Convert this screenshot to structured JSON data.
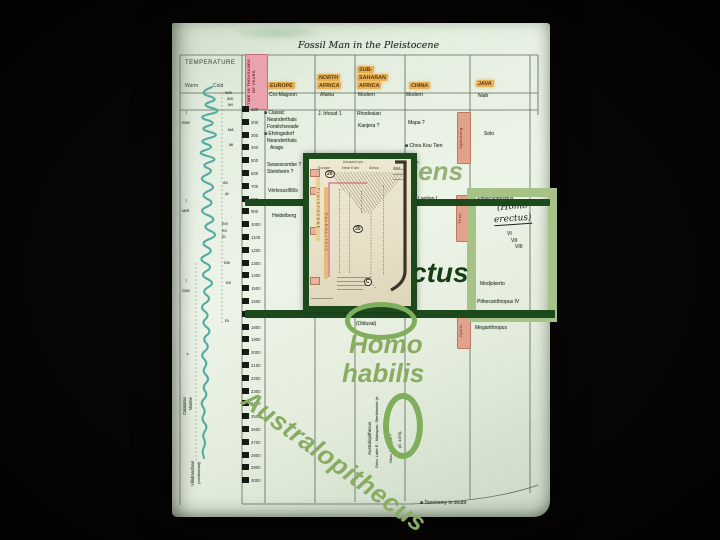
{
  "colors": {
    "dark_green": "#1d4a1d",
    "ctus_green": "#173f17",
    "sage": "#88ac62",
    "sage_light": "#94b274",
    "oval_green": "#7fae5c",
    "box_green": "#a7c287",
    "teal_curve": "#55aaa3",
    "page_bg": "#e6efe2",
    "inset_paper": "#e9e2cb",
    "pink_time_label": "#e8a3ad",
    "orange_highlight": "#e7b159",
    "bed_strip_pink": "#e2a18c"
  },
  "scan": {
    "title": "Fossil Man in the Pleistocene",
    "temperature_header": "TEMPERATURE",
    "warm": "Warm",
    "cold": "Cold",
    "time_axis_label": "TIME IN THOUSANDS OF YEARS",
    "columns": [
      {
        "lines": [
          "EUROPE"
        ],
        "x": 96,
        "y": 59
      },
      {
        "lines": [
          "NORTH",
          "AFRICA"
        ],
        "x": 145,
        "y": 51
      },
      {
        "lines": [
          "SUB-",
          "SAHARAN",
          "AFRICA"
        ],
        "x": 185,
        "y": 43
      },
      {
        "lines": [
          "CHINA"
        ],
        "x": 237,
        "y": 59
      },
      {
        "lines": [
          "JAVA"
        ],
        "x": 304,
        "y": 57
      }
    ],
    "time_ticks": {
      "start": 100,
      "end": 3000,
      "step": 100,
      "x_num": 79,
      "y0": 86,
      "dy": 12.8
    },
    "labels": [
      {
        "t": "Cro-Magnon",
        "x": 97,
        "y": 70
      },
      {
        "t": "Afalou",
        "x": 148,
        "y": 70
      },
      {
        "t": "Modern",
        "x": 186,
        "y": 70
      },
      {
        "t": "Modern",
        "x": 234,
        "y": 70
      },
      {
        "t": "Niah",
        "x": 306,
        "y": 71
      },
      {
        "t": "■ Classic",
        "x": 92,
        "y": 88
      },
      {
        "t": "Neanderthals",
        "x": 95,
        "y": 95
      },
      {
        "t": "Fontéchevade",
        "x": 95,
        "y": 102
      },
      {
        "t": "■ Ehringsdorf",
        "x": 92,
        "y": 109
      },
      {
        "t": "Neanderthals",
        "x": 95,
        "y": 116
      },
      {
        "t": "Arago",
        "x": 98,
        "y": 123
      },
      {
        "t": "J. Irhoud 1",
        "x": 146,
        "y": 89
      },
      {
        "t": "Rhodesian",
        "x": 185,
        "y": 89
      },
      {
        "t": "Kanjera ?",
        "x": 186,
        "y": 101
      },
      {
        "t": "Mapa ?",
        "x": 236,
        "y": 98
      },
      {
        "t": "■ Chou Kou Tien",
        "x": 233,
        "y": 121
      },
      {
        "t": "Swanscombe ?",
        "x": 95,
        "y": 140
      },
      {
        "t": "Steinheim ?",
        "x": 95,
        "y": 147
      },
      {
        "t": "Vértesszőllős",
        "x": 96,
        "y": 166
      },
      {
        "t": "Heidelberg",
        "x": 100,
        "y": 191
      },
      {
        "t": "Lantian I",
        "x": 246,
        "y": 174
      },
      {
        "t": "Solo",
        "x": 312,
        "y": 109
      },
      {
        "t": "■ Pithecanthropus",
        "x": 301,
        "y": 174
      },
      {
        "t": "VI",
        "x": 335,
        "y": 209
      },
      {
        "t": "VII",
        "x": 339,
        "y": 216
      },
      {
        "t": "VIII",
        "x": 343,
        "y": 222
      },
      {
        "t": "Modjokerto",
        "x": 308,
        "y": 259
      },
      {
        "t": "Pithecanthropus IV",
        "x": 305,
        "y": 277
      },
      {
        "t": "Meganthropus",
        "x": 303,
        "y": 303
      },
      {
        "t": "■ Homo habilis",
        "x": 177,
        "y": 291
      },
      {
        "t": "(Olduvai)",
        "x": 184,
        "y": 299
      },
      {
        "t": "■ Taxonomy in doubt",
        "x": 248,
        "y": 478
      },
      {
        "t": "WIII",
        "x": 53,
        "y": 68,
        "s": 3.8
      },
      {
        "t": "WII",
        "x": 55,
        "y": 74,
        "s": 3.8
      },
      {
        "t": "WI",
        "x": 56,
        "y": 80,
        "s": 3.8
      },
      {
        "t": "MA",
        "x": 56,
        "y": 105,
        "s": 3.8
      },
      {
        "t": "MI",
        "x": 57,
        "y": 120,
        "s": 3.8
      },
      {
        "t": "AII",
        "x": 51,
        "y": 158,
        "s": 3.8
      },
      {
        "t": "AI",
        "x": 53,
        "y": 169,
        "s": 3.8
      },
      {
        "t": "EIII",
        "x": 50,
        "y": 199,
        "s": 3.8
      },
      {
        "t": "EII",
        "x": 50,
        "y": 206,
        "s": 3.8
      },
      {
        "t": "EI",
        "x": 50,
        "y": 212,
        "s": 3.8
      },
      {
        "t": "DIII",
        "x": 52,
        "y": 238,
        "s": 3.8
      },
      {
        "t": "DII",
        "x": 54,
        "y": 258,
        "s": 3.8
      },
      {
        "t": "DI",
        "x": 53,
        "y": 296,
        "s": 3.8
      },
      {
        "t": "↕",
        "x": 13,
        "y": 88,
        "s": 5
      },
      {
        "t": "R/W",
        "x": 10,
        "y": 98,
        "s": 4
      },
      {
        "t": "↕",
        "x": 13,
        "y": 176,
        "s": 5
      },
      {
        "t": "M/R",
        "x": 10,
        "y": 186,
        "s": 4
      },
      {
        "t": "↕",
        "x": 13,
        "y": 256,
        "s": 5
      },
      {
        "t": "G/M",
        "x": 10,
        "y": 266,
        "s": 4
      },
      {
        "t": "?",
        "x": 14,
        "y": 330,
        "s": 4.5
      },
      {
        "t": "Calabrian",
        "x": 11,
        "y": 392,
        "r": -90,
        "s": 4.2
      },
      {
        "t": "Marine",
        "x": 17,
        "y": 387,
        "r": -90,
        "s": 4.2
      },
      {
        "t": "Villafranchian",
        "x": 19,
        "y": 463,
        "r": -90,
        "s": 4.2
      },
      {
        "t": "(continental)",
        "x": 25,
        "y": 461,
        "r": -90,
        "s": 4
      },
      {
        "t": "Australopithecus",
        "x": 196,
        "y": 432,
        "r": -90,
        "s": 4.5
      },
      {
        "t": "Omo, Lake E., Makapan, Sterkfontein (a",
        "x": 203,
        "y": 445,
        "r": -90,
        "s": 4
      },
      {
        "t": "Omo, Kanapoi ?",
        "x": 217,
        "y": 440,
        "r": -90,
        "s": 4
      },
      {
        "t": "(E. 1470)",
        "x": 226,
        "y": 425,
        "r": -90,
        "s": 4
      }
    ],
    "bed_strips": [
      {
        "t": "Ngandong",
        "x": 285,
        "y": 89,
        "h": 50
      },
      {
        "t": "Trinil",
        "x": 284,
        "y": 172,
        "h": 45
      },
      {
        "t": "Djetis",
        "x": 285,
        "y": 290,
        "h": 34
      }
    ],
    "handwritten": [
      "(Homo",
      "erectus)"
    ],
    "temperature_curve_points": [
      [
        64,
        40
      ],
      [
        70,
        25
      ],
      [
        76,
        48
      ],
      [
        82,
        28
      ],
      [
        88,
        52
      ],
      [
        94,
        24
      ],
      [
        100,
        46
      ],
      [
        106,
        26
      ],
      [
        112,
        50
      ],
      [
        118,
        25
      ],
      [
        124,
        44
      ],
      [
        130,
        23
      ],
      [
        136,
        48
      ],
      [
        142,
        28
      ],
      [
        148,
        43
      ],
      [
        156,
        25
      ],
      [
        164,
        46
      ],
      [
        172,
        27
      ],
      [
        180,
        44
      ],
      [
        188,
        25
      ],
      [
        196,
        46
      ],
      [
        204,
        29
      ],
      [
        212,
        48
      ],
      [
        220,
        27
      ],
      [
        228,
        43
      ],
      [
        236,
        25
      ],
      [
        244,
        42
      ],
      [
        252,
        27
      ],
      [
        260,
        44
      ],
      [
        268,
        29
      ],
      [
        276,
        40
      ],
      [
        284,
        27
      ],
      [
        292,
        38
      ],
      [
        300,
        29
      ],
      [
        308,
        40
      ],
      [
        316,
        30
      ],
      [
        324,
        38
      ],
      [
        332,
        28
      ],
      [
        340,
        36
      ],
      [
        348,
        30
      ],
      [
        356,
        38
      ],
      [
        364,
        30
      ],
      [
        372,
        36
      ],
      [
        380,
        28
      ],
      [
        388,
        34
      ],
      [
        396,
        29
      ],
      [
        404,
        36
      ],
      [
        412,
        30
      ],
      [
        420,
        34
      ],
      [
        428,
        30
      ],
      [
        435,
        32
      ]
    ]
  },
  "inset": {
    "axis_note": "thousand yrs",
    "col_labels": [
      {
        "t": "Europe",
        "x": 9
      },
      {
        "t": "Near East",
        "x": 33
      },
      {
        "t": "Africa",
        "x": 60
      },
      {
        "t": "Asia",
        "x": 84
      }
    ],
    "circled": [
      {
        "t": "20",
        "x": 16,
        "y": 11
      },
      {
        "t": "35",
        "x": 44,
        "y": 66
      },
      {
        "t": "C",
        "x": 55,
        "y": 119
      }
    ],
    "strips": [
      {
        "t": "PLEISTOCENE",
        "x": 7,
        "y": 18,
        "h": 64,
        "bg": "#e8cf96"
      },
      {
        "t": "PALEOLITHIC",
        "x": 15,
        "y": 28,
        "h": 92,
        "bg": "#e4bd74"
      }
    ]
  },
  "annotations": {
    "sapiens_fragment": "iens",
    "erectus_fragment": "ctus",
    "homo_line": "Homo",
    "habilis_line": "habilis",
    "australopithecus": "Australopithecus"
  }
}
